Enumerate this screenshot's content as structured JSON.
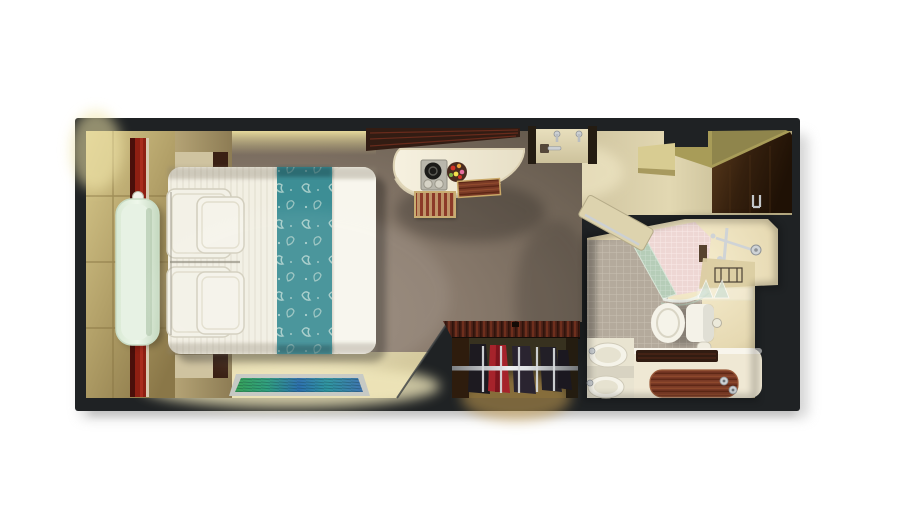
{
  "scene": {
    "type": "cruise-stateroom-floor-plan-3d-top-view",
    "rooms": [
      "cabin",
      "entry-hall",
      "bathroom",
      "closet"
    ],
    "objects": [
      "window-wall-tiles",
      "red-curtain",
      "glass-bench",
      "nightstand",
      "double-bed",
      "pillows",
      "teal-floral-bed-runner",
      "area-rug",
      "overhead-shelf",
      "vanity-desk",
      "serving-tray",
      "kettle",
      "fruit-bowl",
      "wooden-stool",
      "wooden-bench",
      "cabin-door",
      "door-hinges",
      "door-handle",
      "wardrobe-panel",
      "bathroom-door",
      "shower-pink-tiles",
      "shower-glass-panel",
      "shower-fixtures",
      "shower-drain",
      "corner-counter",
      "glass-shelf",
      "toilet",
      "toilet-paper-roll",
      "sink-basins",
      "vanity-counter",
      "wooden-tray",
      "toiletry-bottles",
      "closet-rail",
      "clothes-hangers",
      "hanging-clothes"
    ]
  },
  "palette": {
    "background": "#ffffff",
    "wall": "#1f2224",
    "carpet": "#8a7b6d",
    "floor_cream": "#d5ca9e",
    "tile_wall": "#b3a169",
    "curtain_red": "#8e1f12",
    "curtain_trim": "#d8cab0",
    "glass_bench": "#e7f2e4",
    "nightstand": "#cfc3a0",
    "wood_dark": "#3a2014",
    "duvet": "#f2efe3",
    "duvet_edge": "#f8f6ed",
    "pillow": "#f3f1e7",
    "runner_teal": "#3d8e95",
    "rug_border": "#c6c9c4",
    "desk_white": "#f2ecd9",
    "shelf_wood": "#321c13",
    "stool_red": "#8c3a28",
    "stool_tan": "#bf9468",
    "door_cream": "#ddd3ae",
    "door_frame": "#241c12",
    "wardrobe_brown": "#38220f",
    "ceiling_olive": "#a89c58",
    "tile_grey": "#b4aa9c",
    "tile_pink": "#eed7d4",
    "tile_teal_band": "#b6cdb8",
    "counter_beige": "#dbcda2",
    "fixture_white": "#f4f2e8",
    "silver": "#ccd0d3",
    "tray_wood": "#7a3a26",
    "closet_interior": "#37311f",
    "closet_glow": "#c79f52",
    "cloth_red": "#a6232b",
    "cloth_dark": "#221f27"
  }
}
